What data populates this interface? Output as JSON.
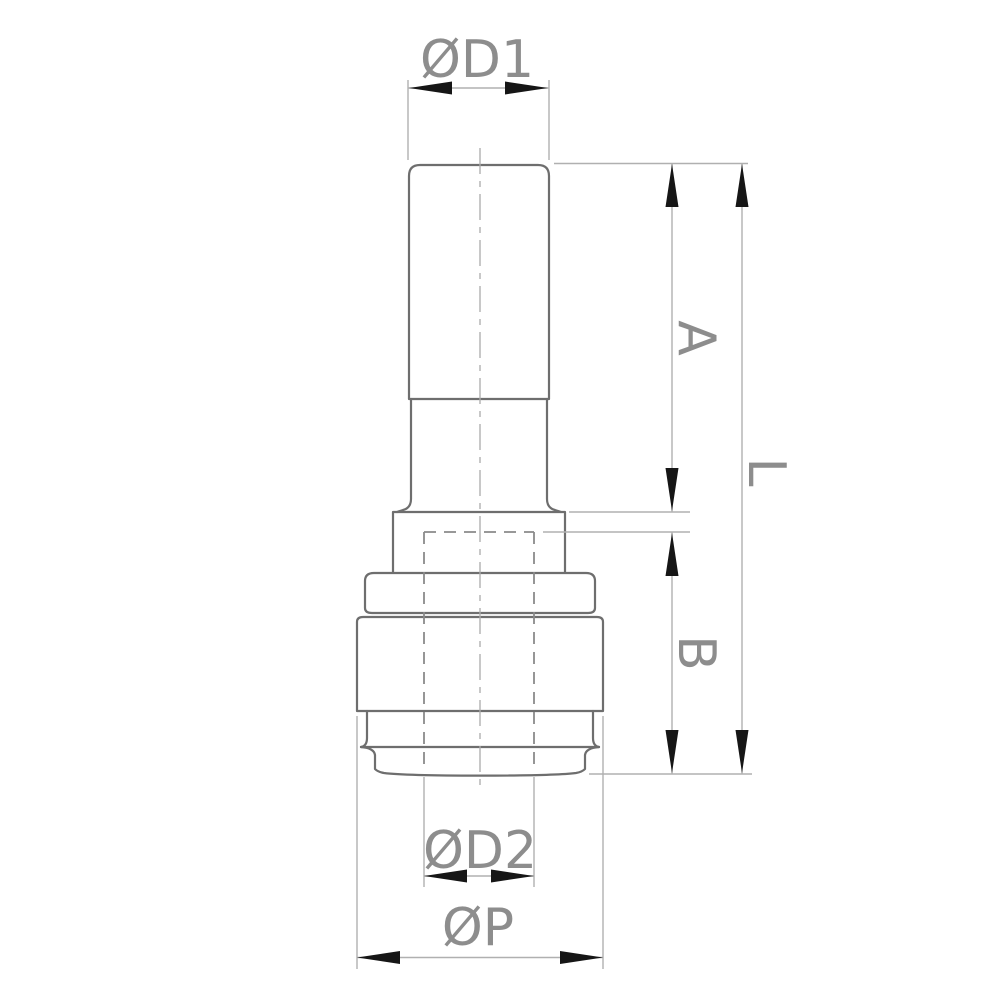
{
  "drawing": {
    "kind": "technical-dimension-drawing",
    "subject": "push-fit tube reducer fitting, front elevation",
    "labels": {
      "d1": "ØD1",
      "a": "A",
      "l": "L",
      "b": "B",
      "d2": "ØD2",
      "p": "ØP"
    },
    "colors": {
      "background": "#ffffff",
      "outline": "#6e6e6e",
      "dimension_lines": "#b0b0b0",
      "hidden_lines": "#8a8a8a",
      "centerline": "#ababab",
      "arrowheads": "#161616",
      "label_text": "#8d8d8d"
    }
  }
}
